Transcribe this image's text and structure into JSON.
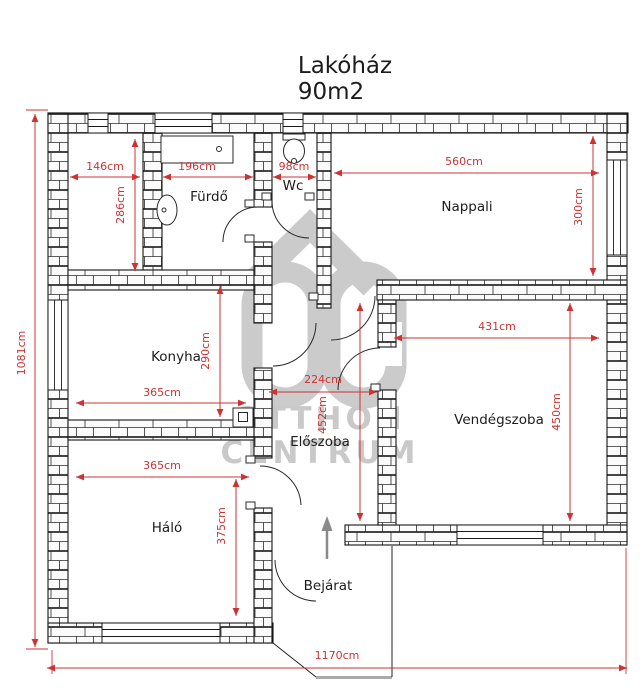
{
  "title": {
    "name": "Lakóház",
    "area": "90m2"
  },
  "watermark": {
    "line1": "OTTHON",
    "line2": "CENTRUM"
  },
  "colors": {
    "dimension_red": "#cc3333",
    "wall_black": "#151515",
    "watermark_gray": "#c9c9c9",
    "background": "#ffffff"
  },
  "rooms": {
    "furdo": {
      "label": "Fürdő"
    },
    "wc": {
      "label": "Wc"
    },
    "nappali": {
      "label": "Nappali"
    },
    "konyha": {
      "label": "Konyha"
    },
    "vendegszoba": {
      "label": "Vendégszoba"
    },
    "eloszoba": {
      "label": "Előszoba"
    },
    "halo": {
      "label": "Háló"
    },
    "bejarat": {
      "label": "Bejárat"
    }
  },
  "dims": {
    "d146": "146cm",
    "d286": "286cm",
    "d196": "196cm",
    "d98": "98cm",
    "d560": "560cm",
    "d300": "300cm",
    "d290": "290cm",
    "d365k": "365cm",
    "d431": "431cm",
    "d450": "450cm",
    "d224": "224cm",
    "d452": "452cm",
    "d365h": "365cm",
    "d375": "375cm",
    "d1081": "1081cm",
    "d1170": "1170cm"
  }
}
